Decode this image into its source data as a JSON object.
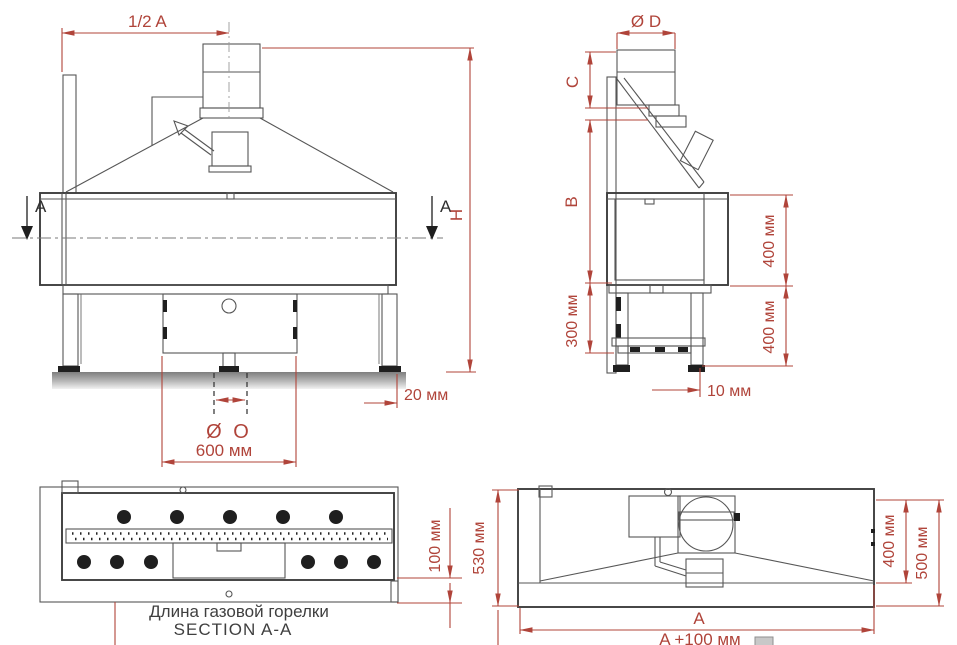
{
  "document": {
    "type": "technical-dimension-drawing",
    "language": "ru",
    "colors": {
      "dimension": "#b0443a",
      "outline": "#3e3e3e",
      "detail": "#565656",
      "caption": "#3f3f3f"
    }
  },
  "front_view": {
    "dim_half_a": "1/2 A",
    "section_marker_left": "A",
    "section_marker_right": "A",
    "dim_height": "H",
    "dim_ground_offset": "20 мм",
    "dim_pipe_diameter": "Ø O",
    "dim_pipe_spacing": "600 мм"
  },
  "side_view": {
    "dim_flue_diameter": "Ø D",
    "dim_c": "C",
    "dim_b": "B",
    "dim_leg_height": "300 мм",
    "dim_body_height_upper": "400 мм",
    "dim_body_height_lower": "400 мм",
    "dim_front_offset": "10 мм"
  },
  "section_view": {
    "dim_burner_offset": "100 мм",
    "caption_line1": "Длина газовой горелки",
    "caption_line2": "SECTION A-A"
  },
  "top_view": {
    "dim_depth_total": "530 мм",
    "dim_hood_depth": "400 мм",
    "dim_depth": "500 мм",
    "dim_width": "A",
    "dim_width_total": "A +100 мм"
  }
}
